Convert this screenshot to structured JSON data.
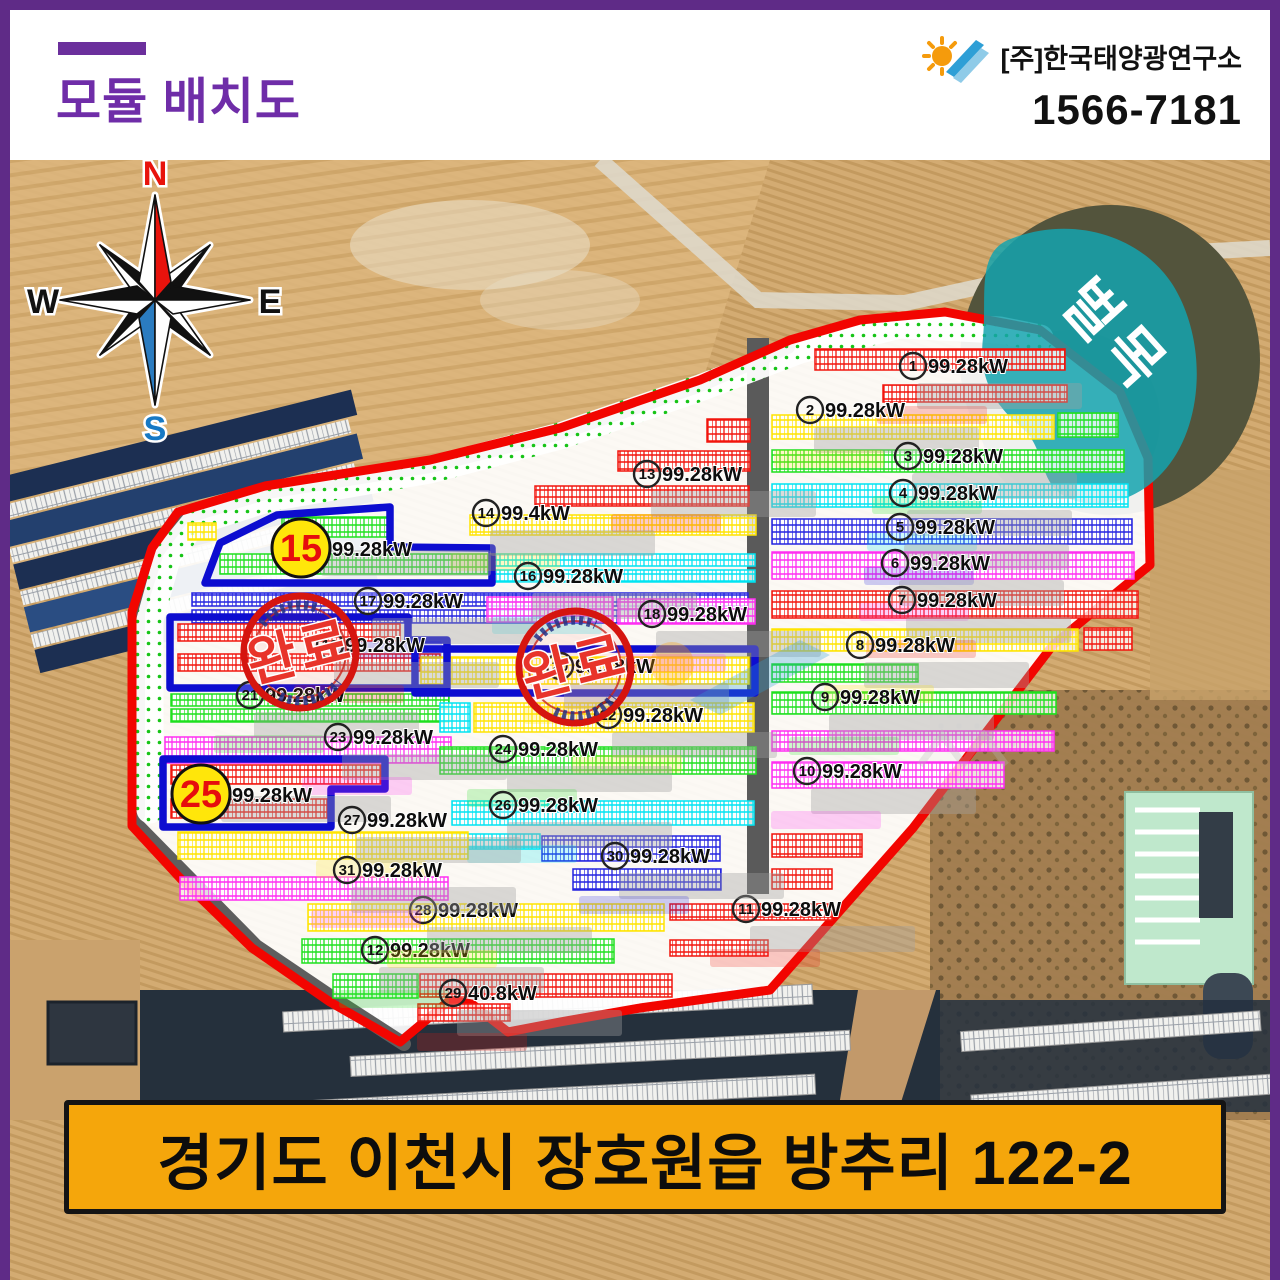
{
  "header": {
    "title": "모듈 배치도",
    "company": "[주]한국태양광연구소",
    "phone": "1566-7181"
  },
  "footer": {
    "address": "경기도 이천시 장호원읍 방추리 122-2"
  },
  "colors": {
    "frame": "#5f2b87",
    "title": "#6f2da8",
    "banner_bg": "#f5a60b",
    "boundary_red": "#f20500",
    "road_gray": "#5a5a5a",
    "outline_blue": "#0d0dd0",
    "stamp_red": "#d5150f",
    "highlight_circle_fill": "#ffe60a",
    "highlight_number": "#e60d0d",
    "logging_teal": "#14a3ae",
    "panel": {
      "red": "#f2150d",
      "yellow": "#ffe400",
      "green": "#1ee01e",
      "cyan": "#00e4f2",
      "blue": "#2424e0",
      "magenta": "#ff2ef2"
    }
  },
  "map": {
    "compass": {
      "n": "N",
      "s": "S",
      "e": "E",
      "w": "W"
    },
    "logging_label": "벌목",
    "stamp_label": "완료",
    "arrays": [
      {
        "n": "1",
        "kw": "99.28kW",
        "color": "red",
        "label": [
          913,
          366
        ],
        "segs": [
          [
            815,
            349,
            250,
            21
          ],
          [
            883,
            385,
            184,
            17
          ]
        ]
      },
      {
        "n": "2",
        "kw": "99.28kW",
        "color": "yellow",
        "label": [
          810,
          410
        ],
        "segs": [
          [
            772,
            415,
            282,
            24
          ],
          [
            1058,
            413,
            60,
            24,
            "green"
          ]
        ]
      },
      {
        "n": "3",
        "kw": "99.28kW",
        "color": "green",
        "label": [
          908,
          456
        ],
        "segs": [
          [
            772,
            450,
            352,
            22
          ]
        ]
      },
      {
        "n": "4",
        "kw": "99.28kW",
        "color": "cyan",
        "label": [
          903,
          493
        ],
        "segs": [
          [
            772,
            484,
            356,
            23
          ]
        ]
      },
      {
        "n": "5",
        "kw": "99.28kW",
        "color": "blue",
        "label": [
          900,
          527
        ],
        "segs": [
          [
            772,
            519,
            360,
            25
          ]
        ]
      },
      {
        "n": "6",
        "kw": "99.28kW",
        "color": "magenta",
        "label": [
          895,
          563
        ],
        "segs": [
          [
            772,
            552,
            362,
            27
          ]
        ]
      },
      {
        "n": "7",
        "kw": "99.28kW",
        "color": "red",
        "label": [
          902,
          600
        ],
        "segs": [
          [
            772,
            591,
            366,
            27
          ]
        ]
      },
      {
        "n": "8",
        "kw": "99.28kW",
        "color": "yellow",
        "label": [
          860,
          645
        ],
        "segs": [
          [
            772,
            629,
            306,
            22
          ],
          [
            1084,
            628,
            48,
            22,
            "red"
          ]
        ]
      },
      {
        "n": "9",
        "kw": "99.28kW",
        "color": "green",
        "label": [
          825,
          697
        ],
        "segs": [
          [
            772,
            664,
            146,
            18
          ],
          [
            772,
            692,
            284,
            22
          ]
        ]
      },
      {
        "n": "10",
        "kw": "99.28kW",
        "color": "magenta",
        "label": [
          807,
          771
        ],
        "segs": [
          [
            772,
            731,
            282,
            20
          ],
          [
            772,
            762,
            232,
            26
          ]
        ]
      },
      {
        "n": "11",
        "kw": "99.28kW",
        "color": "red",
        "label": [
          746,
          909
        ],
        "segs": [
          [
            772,
            834,
            90,
            23
          ],
          [
            772,
            869,
            60,
            20
          ],
          [
            670,
            904,
            162,
            16
          ],
          [
            670,
            940,
            98,
            16
          ]
        ]
      },
      {
        "n": "12",
        "kw": "99.28kW",
        "color": "green",
        "label": [
          375,
          950
        ],
        "segs": [
          [
            302,
            939,
            312,
            24
          ],
          [
            333,
            974,
            85,
            24
          ]
        ]
      },
      {
        "n": "13",
        "kw": "99.28kW",
        "color": "red",
        "label": [
          647,
          474
        ],
        "segs": [
          [
            707,
            419,
            43,
            23
          ],
          [
            618,
            451,
            132,
            20
          ],
          [
            535,
            486,
            214,
            20
          ]
        ]
      },
      {
        "n": "14",
        "kw": "99.4kW",
        "color": "yellow",
        "label": [
          486,
          513
        ],
        "segs": [
          [
            188,
            523,
            28,
            17
          ],
          [
            470,
            515,
            286,
            20
          ]
        ]
      },
      {
        "n": "15",
        "kw": "99.28kW",
        "color": "green",
        "big": [
          301,
          548
        ],
        "segs": [
          [
            282,
            517,
            108,
            20
          ],
          [
            220,
            554,
            268,
            20
          ]
        ]
      },
      {
        "n": "16",
        "kw": "99.28kW",
        "color": "cyan",
        "label": [
          528,
          576
        ],
        "segs": [
          [
            493,
            554,
            262,
            12
          ],
          [
            493,
            570,
            262,
            12
          ]
        ]
      },
      {
        "n": "17",
        "kw": "99.28kW",
        "color": "blue",
        "label": [
          368,
          601
        ],
        "segs": [
          [
            192,
            593,
            556,
            13
          ],
          [
            192,
            610,
            540,
            13
          ]
        ]
      },
      {
        "n": "18",
        "kw": "99.28kW",
        "color": "magenta",
        "label": [
          652,
          614
        ],
        "segs": [
          [
            487,
            597,
            126,
            25
          ],
          [
            618,
            599,
            137,
            25
          ]
        ]
      },
      {
        "n": "19",
        "kw": "99.28kW",
        "color": "red",
        "label": [
          330,
          645
        ],
        "segs": [
          [
            178,
            624,
            222,
            17
          ],
          [
            178,
            654,
            262,
            17
          ]
        ]
      },
      {
        "n": "20",
        "kw": "99.28kW",
        "color": "yellow",
        "label": [
          560,
          666
        ],
        "segs": [
          [
            421,
            657,
            328,
            27
          ]
        ]
      },
      {
        "n": "21",
        "kw": "99.28kW",
        "color": "green",
        "label": [
          250,
          695
        ],
        "segs": [
          [
            171,
            694,
            278,
            12
          ],
          [
            171,
            709,
            278,
            13
          ]
        ]
      },
      {
        "n": "22",
        "kw": "99.28kW",
        "color": "yellow",
        "label": [
          608,
          715
        ],
        "segs": [
          [
            440,
            703,
            30,
            29,
            "cyan"
          ],
          [
            474,
            703,
            280,
            29
          ]
        ]
      },
      {
        "n": "23",
        "kw": "99.28kW",
        "color": "magenta",
        "label": [
          338,
          737
        ],
        "segs": [
          [
            165,
            737,
            286,
            26
          ]
        ]
      },
      {
        "n": "24",
        "kw": "99.28kW",
        "color": "green",
        "label": [
          503,
          749
        ],
        "segs": [
          [
            440,
            747,
            316,
            27
          ]
        ]
      },
      {
        "n": "25",
        "kw": "99.28kW",
        "color": "red",
        "big": [
          201,
          794
        ],
        "segs": [
          [
            171,
            765,
            210,
            19
          ],
          [
            171,
            799,
            156,
            19
          ]
        ]
      },
      {
        "n": "26",
        "kw": "99.28kW",
        "color": "cyan",
        "label": [
          503,
          805
        ],
        "segs": [
          [
            452,
            801,
            302,
            24
          ],
          [
            452,
            834,
            88,
            15
          ]
        ]
      },
      {
        "n": "27",
        "kw": "99.28kW",
        "color": "yellow",
        "label": [
          352,
          820
        ],
        "segs": [
          [
            178,
            832,
            290,
            27
          ]
        ]
      },
      {
        "n": "28",
        "kw": "99.28kW",
        "color": "yellow",
        "label": [
          423,
          910
        ],
        "segs": [
          [
            308,
            904,
            356,
            27
          ]
        ]
      },
      {
        "n": "29",
        "kw": "40.8kW",
        "color": "red",
        "label": [
          453,
          993
        ],
        "segs": [
          [
            420,
            974,
            252,
            23
          ],
          [
            418,
            1004,
            92,
            17
          ]
        ]
      },
      {
        "n": "30",
        "kw": "99.28kW",
        "color": "blue",
        "label": [
          615,
          856
        ],
        "segs": [
          [
            542,
            836,
            178,
            25
          ],
          [
            573,
            869,
            148,
            21
          ]
        ]
      },
      {
        "n": "31",
        "kw": "99.28kW",
        "color": "magenta",
        "label": [
          347,
          870
        ],
        "segs": [
          [
            180,
            877,
            268,
            23
          ]
        ]
      }
    ],
    "completed_outlines": [
      {
        "name": "outline-area-15",
        "points": "205,583 220,543 277,515 390,507 390,547 492,548 492,583"
      },
      {
        "name": "outline-area-19",
        "points": "170,617 408,617 408,640 447,640 447,688 170,688"
      },
      {
        "name": "outline-area-20",
        "points": "415,649 755,649 755,693 415,693"
      },
      {
        "name": "outline-area-25",
        "points": "163,759 385,759 385,789 331,789 331,827 163,827"
      }
    ]
  }
}
